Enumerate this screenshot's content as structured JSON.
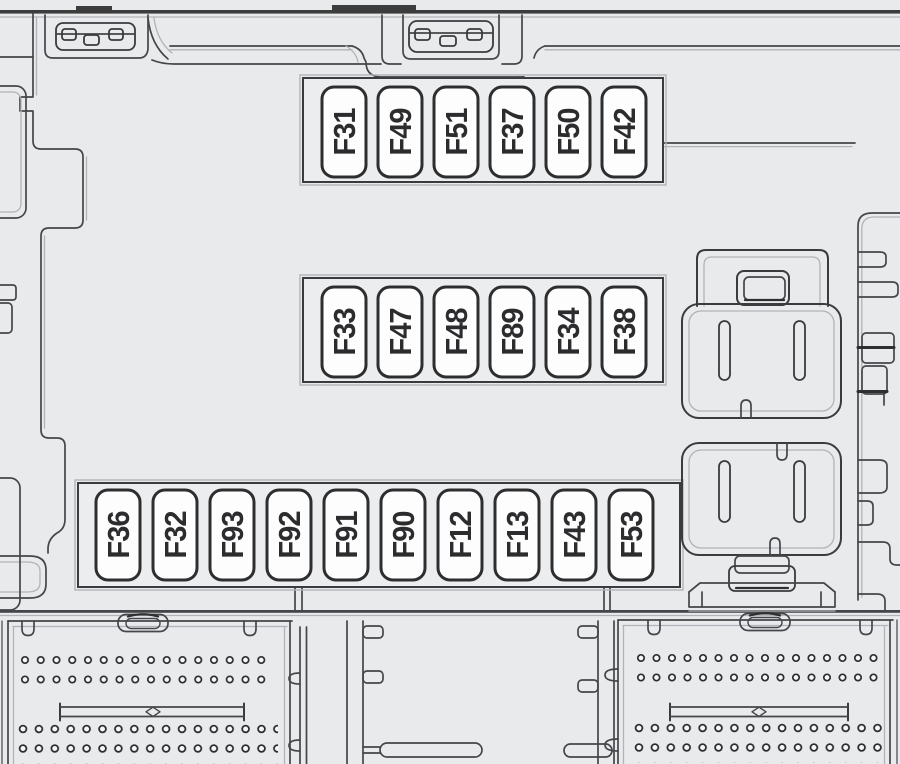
{
  "diagram": {
    "type": "fuse-box-diagram",
    "fuse_rows": {
      "top": [
        "F31",
        "F49",
        "F51",
        "F37",
        "F50",
        "F42"
      ],
      "middle": [
        "F33",
        "F47",
        "F48",
        "F89",
        "F34",
        "F38"
      ],
      "bottom": [
        "F36",
        "F32",
        "F93",
        "F92",
        "F91",
        "F90",
        "F12",
        "F13",
        "F43",
        "F53"
      ]
    },
    "components": {
      "relay_upper": "relay with plug-in connector (upper right)",
      "relay_lower": "relay with plug-in connector (lower right)",
      "connector_block_left": "multi-pin terminal block (bottom left)",
      "connector_block_right": "multi-pin terminal block (bottom right)"
    },
    "colors": {
      "background": "#e9eaec",
      "line": "#45464a",
      "dark_line": "#2f2f30",
      "fuse_fill": "#fdfdfe",
      "panel_fill": "#ecedef"
    }
  }
}
